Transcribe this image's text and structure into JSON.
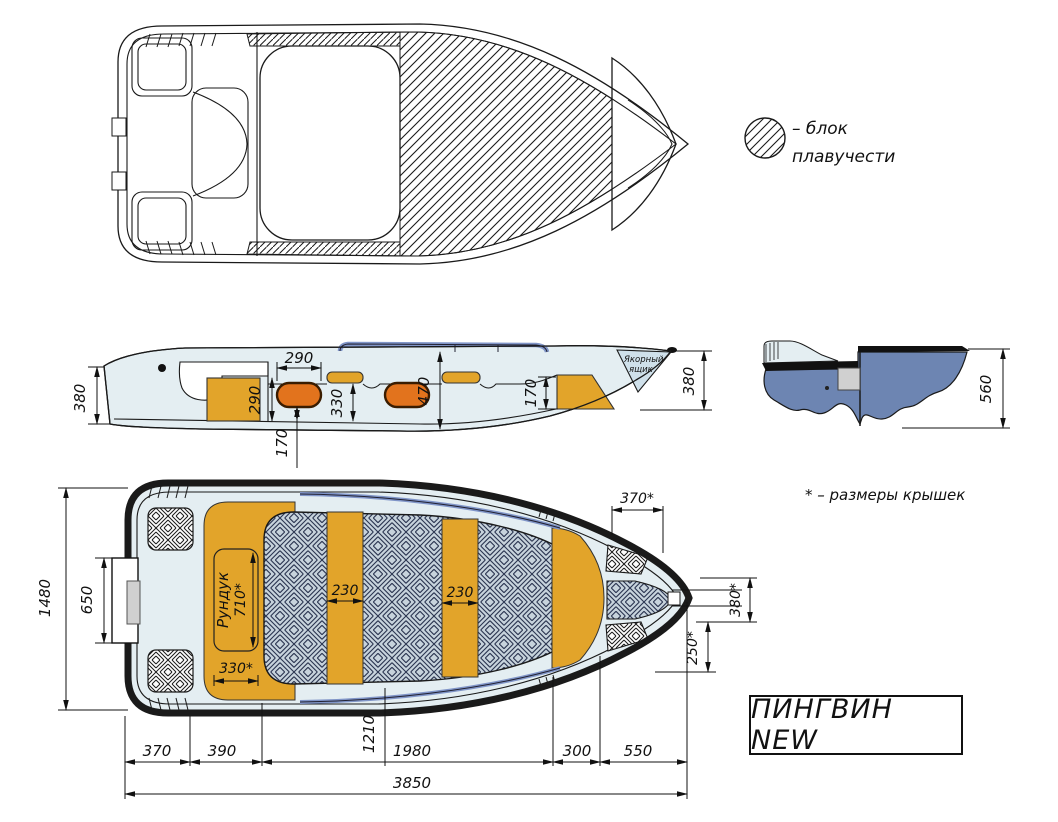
{
  "title": "ПИНГВИН NEW",
  "note": "* – размеры крышек",
  "legend": {
    "line1": "– блок",
    "line2": "плавучести"
  },
  "side_view": {
    "transom_height": "380",
    "seat_len": "290",
    "locker_height": "290",
    "mid_depth": "330",
    "cockpit_depth": "470",
    "seat_height": "170",
    "bow_seat_height": "170",
    "bow_height": "380",
    "anchor_line1": "Якорный",
    "anchor_line2": "ящик"
  },
  "section_view": {
    "height": "560"
  },
  "plan_view": {
    "beam": "1480",
    "transom_recess": "650",
    "locker_label": "Рундук",
    "locker_length": "710*",
    "locker_width": "330*",
    "thwart1": "230",
    "thwart2": "230",
    "bow_lid_width": "370*",
    "bow_lid_height": "380*",
    "bow_lid_depth": "250*"
  },
  "bottom_dims": {
    "seg1": "370",
    "seg2": "390",
    "seg3": "1980",
    "seg4": "300",
    "seg5": "550",
    "mid": "1210",
    "total": "3850"
  },
  "colors": {
    "amber": "#e2a42a",
    "orange": "#e2731d",
    "pale_interior": "#e4eef2",
    "weave_bg": "#c7d3dc",
    "hull_blue": "#6d85b2",
    "rail_blue": "#8095c8",
    "gray_pad": "#d0d0d0",
    "line": "#1a1a1a"
  }
}
